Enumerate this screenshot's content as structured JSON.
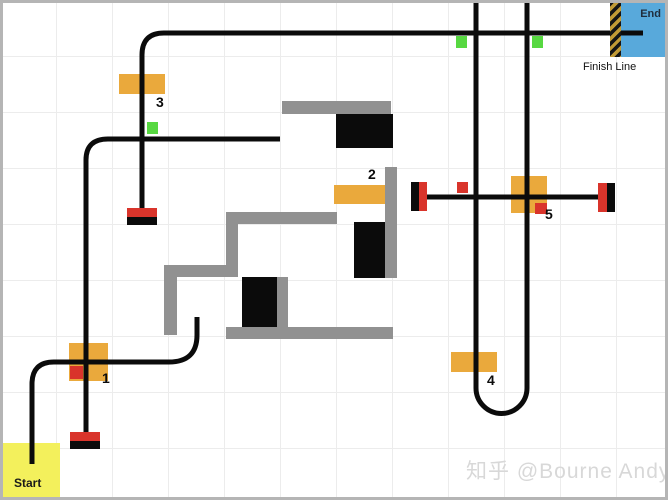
{
  "start": {
    "label": "Start"
  },
  "finish": {
    "end_label": "End",
    "finish_line_label": "Finish Line"
  },
  "checkpoints": [
    {
      "label": "1"
    },
    {
      "label": "2"
    },
    {
      "label": "3"
    },
    {
      "label": "4"
    },
    {
      "label": "5"
    }
  ],
  "watermark": {
    "text": "知乎 @Bourne Andy"
  },
  "colors": {
    "track": "#0b0b0b",
    "wall": "#919191",
    "obstacle": "#0b0b0b",
    "checkpoint": "#eaa93c",
    "red_marker": "#d9342b",
    "green_marker": "#57d841",
    "start_fill": "#f3f05c",
    "end_fill": "#58a9db",
    "hatch_yellow": "#c19a35",
    "grid_line": "#ececec",
    "border": "#b5b5b5",
    "end_text": "#1f2d3d",
    "watermark": "#d8d8d8"
  }
}
